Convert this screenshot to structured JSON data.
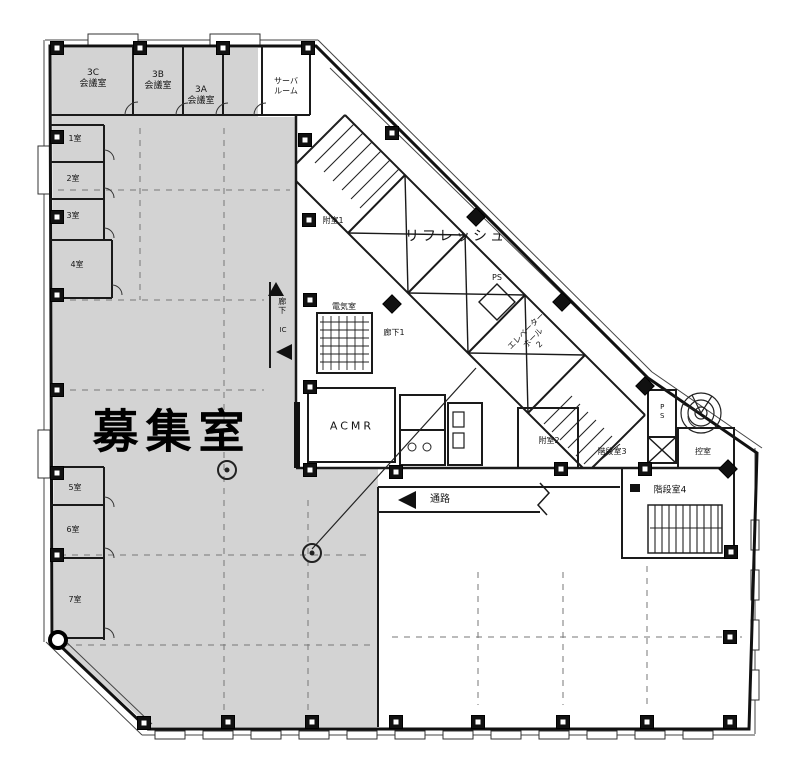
{
  "plan": {
    "colors": {
      "zone_fill": "#d3d3d3",
      "line": "#1a1a1a",
      "grid_dash": "#777777"
    },
    "highlight": {
      "label": "募集室"
    },
    "top_rooms": [
      {
        "id": "3c",
        "line1": "3C",
        "line2": "会議室"
      },
      {
        "id": "3b",
        "line1": "3B",
        "line2": "会議室"
      },
      {
        "id": "3a",
        "line1": "3A",
        "line2": "会議室"
      },
      {
        "id": "server",
        "line1": "サーバ",
        "line2": "ルーム"
      }
    ],
    "left_rooms": [
      {
        "label": "1室"
      },
      {
        "label": "2室"
      },
      {
        "label": "3室"
      },
      {
        "label": "4室"
      },
      {
        "label": "5室"
      },
      {
        "label": "6室"
      },
      {
        "label": "7室"
      }
    ],
    "core": {
      "refresh": "リフレッシュ",
      "vestibule1": "附室1",
      "vestibule2": "附室2",
      "corridor": "廊下",
      "corridor1": "廊下1",
      "ic": "IC",
      "electrical": "電気室",
      "acmr": "ACMR",
      "elevator_hall": {
        "line1": "エレベーター",
        "line2": "ホール",
        "line3": "2"
      },
      "pipe_shaft": "PS",
      "stair3": "階段室3",
      "stair4": "階段室4",
      "anteroom": "控室",
      "passage": "通路"
    }
  }
}
